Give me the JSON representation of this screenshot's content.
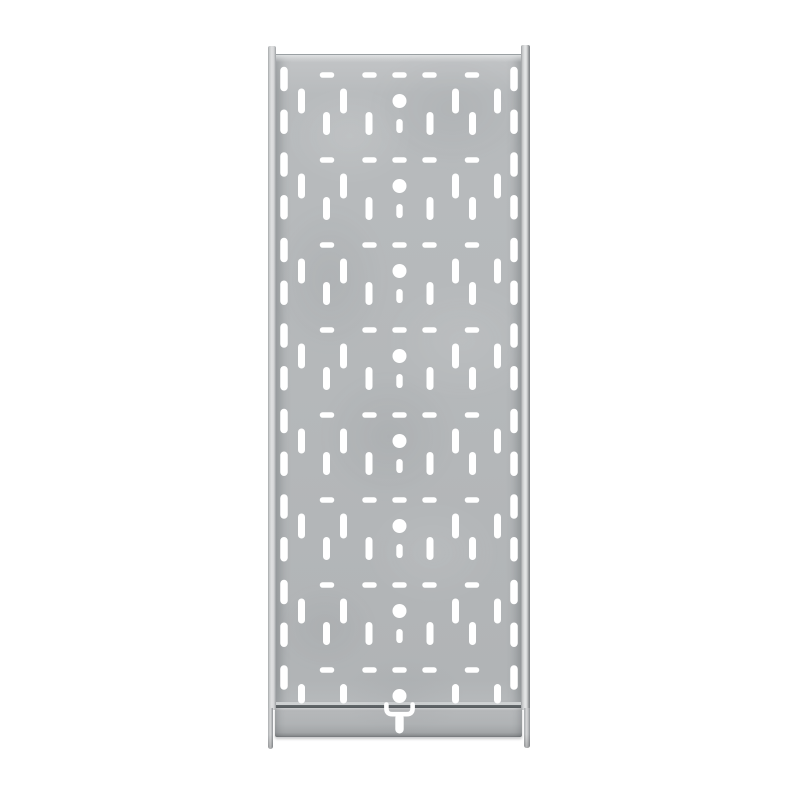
{
  "scene": {
    "type": "product-photo",
    "subject": "perforated galvanized steel cable tray, straight section, top view",
    "background_color": "#ffffff",
    "visible_text": ""
  },
  "palette": {
    "panel_base": "#b5b8ba",
    "panel_light": "#c3c5c7",
    "panel_dark": "#a3a6a8",
    "rail_highlight": "#e6e7e8",
    "rail_edge_dark": "#808386",
    "seam_dark": "#565b5e",
    "flange_bottom_edge": "#74787b",
    "hole_color": "#ffffff"
  },
  "pattern": {
    "hole_color": "#ffffff",
    "units": 8,
    "first_y": 101,
    "period": 85,
    "center_x": 399.5,
    "circle_r": 7,
    "dash_dy": -26,
    "dash_w": 14.5,
    "dash_h": 5.5,
    "dash_x": [
      327,
      369.5,
      399.5,
      429.5,
      472
    ],
    "slot_w": 7,
    "row_a_h": 25,
    "row_a_x": [
      301.5,
      343.5,
      455.5,
      497.5
    ],
    "row_a_last_h": 19.5,
    "row_a_last_dy": -2.2,
    "row_b_h": 23,
    "row_b_dy": 22.5,
    "row_b_x": [
      326.5,
      369,
      430,
      472.5
    ],
    "stem_w": 6.4,
    "stem_h": 14,
    "stem_dy": 25,
    "edge_x": [
      284,
      514
    ],
    "edge_w": 7.5,
    "edge_h": 24.5,
    "edge_first_y": 79,
    "edge_step": 42.75,
    "edge_count": 15,
    "coupling": {
      "u_path": "M 386.4 704.5 L 386.4 708.4 Q 386.4 714.2 392.2 714.2 L 406.8 714.2 Q 412.6 714.2 412.6 708.4 L 412.6 704.5",
      "stroke_width": 4.6,
      "stem_cx": 399.5,
      "stem_cy": 723.5,
      "stem_w": 8.4,
      "stem_h": 20
    }
  }
}
